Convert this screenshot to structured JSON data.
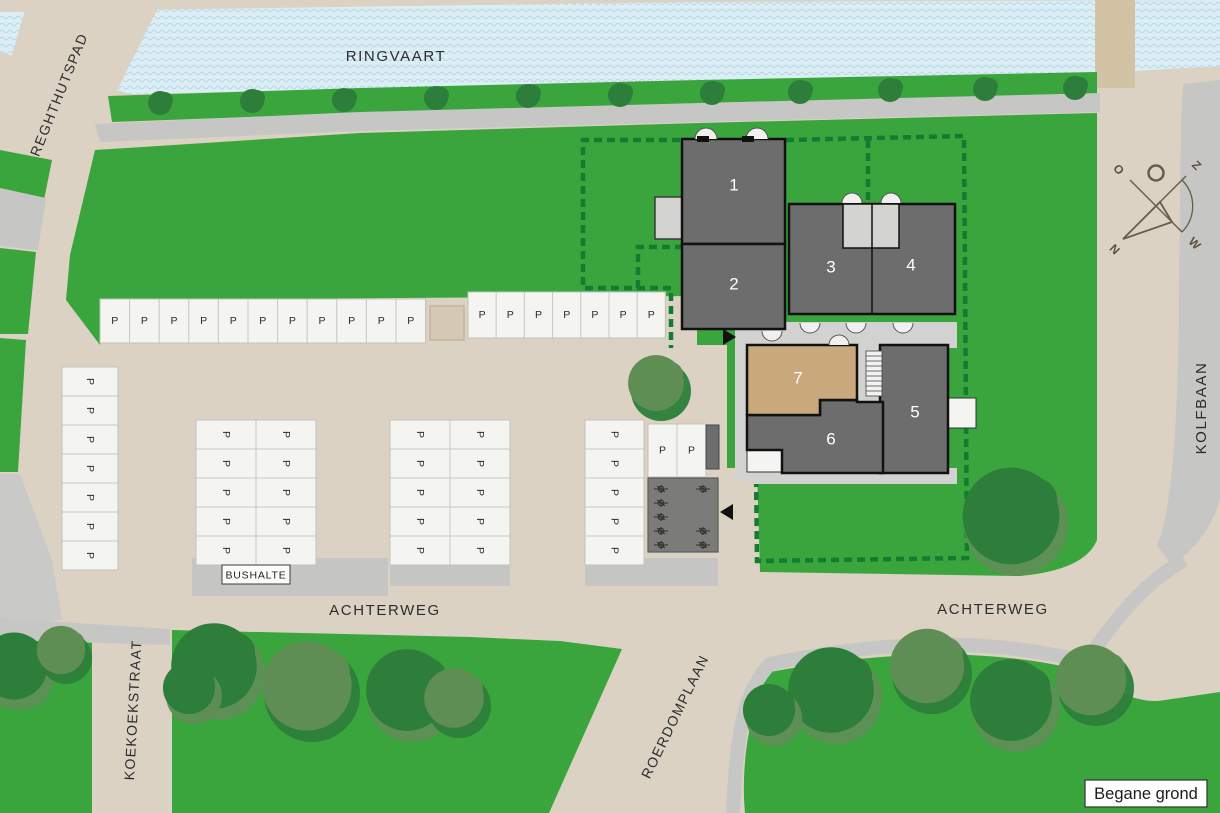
{
  "map": {
    "floor_label": "Begane grond",
    "streets": {
      "ringvaart": "RINGVAART",
      "reghthutspad": "REGHTHUTSPAD",
      "kolfbaan": "KOLFBAAN",
      "achterweg_west": "ACHTERWEG",
      "achterweg_east": "ACHTERWEG",
      "koekoekstraat": "KOEKOEKSTRAAT",
      "roerdomplaan": "ROERDOMPLAAN"
    },
    "bus_stop_label": "BUSHALTE",
    "compass": {
      "n": "N",
      "o": "O",
      "z": "Z",
      "w": "W"
    }
  },
  "buildings": [
    {
      "label": "1",
      "fill": "#6d6d6d"
    },
    {
      "label": "2",
      "fill": "#6d6d6d"
    },
    {
      "label": "3",
      "fill": "#6d6d6d"
    },
    {
      "label": "4",
      "fill": "#6d6d6d"
    },
    {
      "label": "5",
      "fill": "#6d6d6d"
    },
    {
      "label": "6",
      "fill": "#6d6d6d"
    },
    {
      "label": "7",
      "fill": "#c9a97b"
    }
  ],
  "parking": {
    "stall_label": "P",
    "groups": [
      {
        "id": "row-north-west",
        "count": 11
      },
      {
        "id": "row-north-east",
        "count": 7
      },
      {
        "id": "column-west",
        "count": 7
      },
      {
        "id": "block-center-west",
        "count": 10
      },
      {
        "id": "block-center",
        "count": 10
      },
      {
        "id": "block-center-east",
        "count": 5
      },
      {
        "id": "pair-east",
        "count": 2
      }
    ],
    "total_stalls": 52
  },
  "colors": {
    "water": "#dceef5",
    "wave": "#b5d7e3",
    "grass": "#3aa53c",
    "road_beige": "#dbd2c3",
    "path_gray": "#c6c6c4",
    "hedge_green": "#127c30",
    "building_gray": "#6d6d6d",
    "building_tan": "#c9a97b",
    "tree_dark": "#2c7e3a",
    "tree_olive": "#5f8e55"
  }
}
